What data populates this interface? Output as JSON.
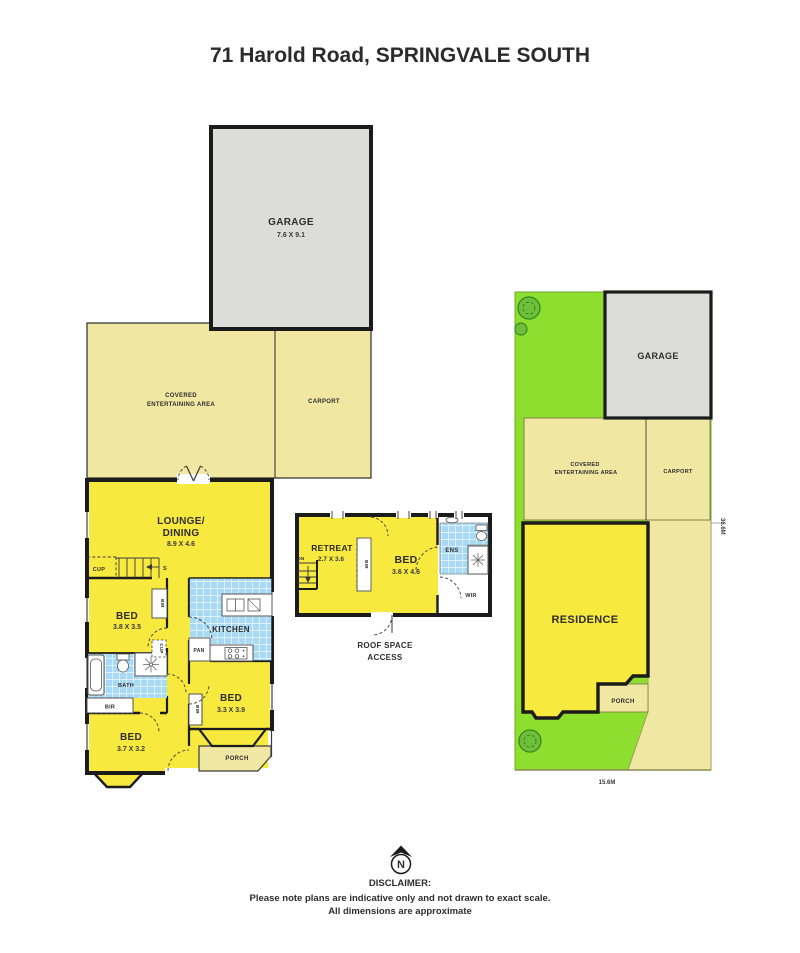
{
  "page": {
    "title": "71 Harold Road, SPRINGVALE SOUTH"
  },
  "colors": {
    "house_yellow": "#f8e93f",
    "outdoor_yellow": "#f0e7a2",
    "garage_grey": "#dcdcda",
    "lawn_green": "#8ede2f",
    "tile_blue": "#a9daf5",
    "wall_black": "#1b1b1b"
  },
  "ground_floor": {
    "garage": {
      "label": "GARAGE",
      "dims": "7.6 X 9.1"
    },
    "covered_area": {
      "label_line1": "COVERED",
      "label_line2": "ENTERTAINING AREA"
    },
    "carport": {
      "label": "CARPORT"
    },
    "lounge_dining": {
      "label_line1": "LOUNGE/",
      "label_line2": "DINING",
      "dims": "8.9 X 4.6"
    },
    "stairs": {
      "label": "S"
    },
    "cupboard_hall": {
      "label": "CUP"
    },
    "bed1": {
      "label": "BED",
      "dims": "3.8 X 3.5"
    },
    "robe1": {
      "label": "BIR"
    },
    "kitchen": {
      "label": "KITCHEN"
    },
    "pantry": {
      "label": "PAN"
    },
    "bath": {
      "label": "BATH"
    },
    "cupboard_bath": {
      "label": "CUP"
    },
    "robe2": {
      "label": "BIR"
    },
    "bed2": {
      "label": "BED",
      "dims": "3.3 X 3.9"
    },
    "robe3": {
      "label": "BIR"
    },
    "bed3": {
      "label": "BED",
      "dims": "3.7 X 3.2"
    },
    "porch": {
      "label": "PORCH"
    }
  },
  "first_floor": {
    "retreat": {
      "label": "RETREAT",
      "dims": "2.7 X 3.6"
    },
    "stairs": {
      "label": "DN"
    },
    "robe": {
      "label": "BIR"
    },
    "bed": {
      "label": "BED",
      "dims": "3.6 X 4.6"
    },
    "ensuite": {
      "label": "ENS"
    },
    "wir": {
      "label": "WIR"
    },
    "caption_line1": "ROOF SPACE",
    "caption_line2": "ACCESS"
  },
  "site_plan": {
    "garage": {
      "label": "GARAGE"
    },
    "covered_area": {
      "label_line1": "COVERED",
      "label_line2": "ENTERTAINING AREA"
    },
    "carport": {
      "label": "CARPORT"
    },
    "residence": {
      "label": "RESIDENCE"
    },
    "porch": {
      "label": "PORCH"
    },
    "frontage_dim": "15.6M",
    "depth_dim": "36.6M"
  },
  "compass": {
    "label": "N"
  },
  "disclaimer": {
    "heading": "DISCLAIMER:",
    "line1": "Please note plans are indicative only and not drawn to exact scale.",
    "line2": "All dimensions are approximate"
  }
}
